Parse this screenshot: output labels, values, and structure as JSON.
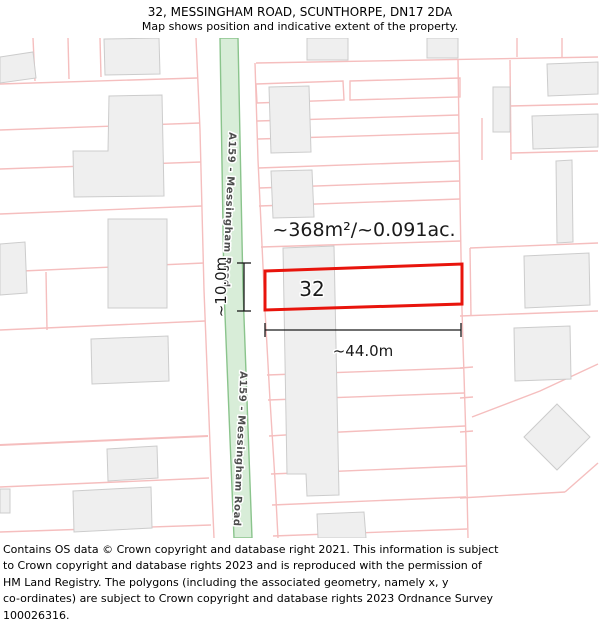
{
  "header": {
    "title": "32, MESSINGHAM ROAD, SCUNTHORPE, DN17 2DA",
    "subtitle": "Map shows position and indicative extent of the property."
  },
  "map": {
    "plot_label": "32",
    "area_label": "~368m²/~0.091ac.",
    "width_label": "~44.0m",
    "depth_label": "~10.0m",
    "road_label": "A159 - Messingham Road",
    "colors": {
      "plot_outline": "#e8140c",
      "road_fill": "#d8edd8",
      "road_edge": "#8ac48c",
      "parcel_line": "#f5bebe",
      "building_fill": "#efefef",
      "building_edge": "#cccccc",
      "dimension": "#1a1a1a",
      "road_label_text": "#4d4d4d"
    }
  },
  "footer": {
    "lines": [
      "Contains OS data © Crown copyright and database right 2021. This information is subject",
      "to Crown copyright and database rights 2023 and is reproduced with the permission of",
      "HM Land Registry. The polygons (including the associated geometry, namely x, y",
      "co-ordinates) are subject to Crown copyright and database rights 2023 Ordnance Survey",
      "100026316."
    ]
  }
}
